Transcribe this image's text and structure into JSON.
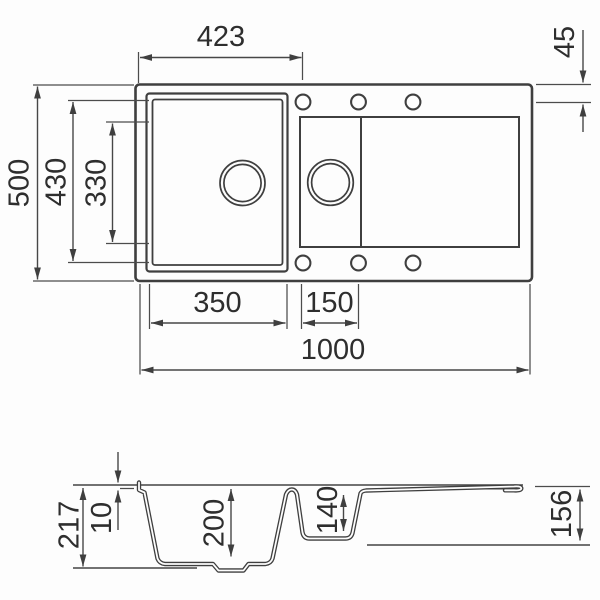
{
  "drawing_title": "sink-dimension-drawing",
  "style": {
    "line_color": "#3f3f3f",
    "text_color": "#2e2e2e",
    "background": "#fdfdfd"
  },
  "top_view": {
    "dims": {
      "bowl_left_offset": "423",
      "hole_offset_from_edge": "45",
      "overall_depth": "500",
      "bowl_outer_depth": "430",
      "bowl_inner_depth": "330",
      "main_bowl_width": "350",
      "half_bowl_width": "150",
      "overall_width": "1000"
    }
  },
  "section_view": {
    "dims": {
      "overall_height": "217",
      "rim_height": "10",
      "main_bowl_depth": "200",
      "half_bowl_depth": "140",
      "drainer_end_height": "156"
    }
  }
}
